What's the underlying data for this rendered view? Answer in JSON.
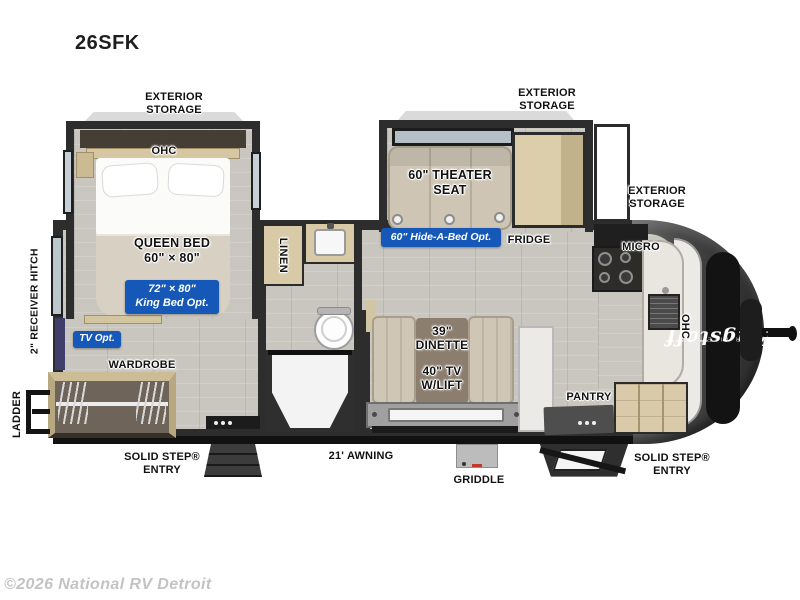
{
  "colors": {
    "accent_blue": "#1558b8",
    "wall": "#2d2d2d",
    "label_ink": "#111111",
    "watermark_gray": "#c3c3c3",
    "wood_cabinet": "#d9caa7",
    "upholstery": "#cfc6b5",
    "cap_dark": "#383838"
  },
  "labels": {
    "title": "26SFK",
    "exterior_storage_bedroom": "EXTERIOR\nSTORAGE",
    "exterior_storage_theater": "EXTERIOR\nSTORAGE",
    "exterior_storage_front": "EXTERIOR\nSTORAGE",
    "ohc_bedroom": "OHC",
    "queen_bed": "QUEEN BED\n60\" × 80\"",
    "king_bed_option": "72\" × 80\"\nKing Bed Opt.",
    "tv_option": "TV Opt.",
    "wardrobe": "WARDROBE",
    "linen": "LINEN",
    "theater_seat": "60\" THEATER\nSEAT",
    "hide_a_bed_option": "60\" Hide-A-Bed Opt.",
    "fridge": "FRIDGE",
    "micro": "MICRO",
    "ohc_kitchen": "OHC",
    "dinette": "39\"\nDINETTE",
    "tv_lift": "40\" TV\nW/LIFT",
    "pantry": "PANTRY",
    "griddle": "GRIDDLE",
    "awning": "21' AWNING",
    "entry_left": "SOLID STEP®\nENTRY",
    "entry_right": "SOLID STEP®\nENTRY",
    "ladder": "LADDER",
    "receiver_hitch": "2\" RECEIVER HITCH"
  },
  "brand": {
    "logo": "Flagstaff",
    "series": "SUPER LITE"
  },
  "watermark": "©2026 National RV Detroit"
}
